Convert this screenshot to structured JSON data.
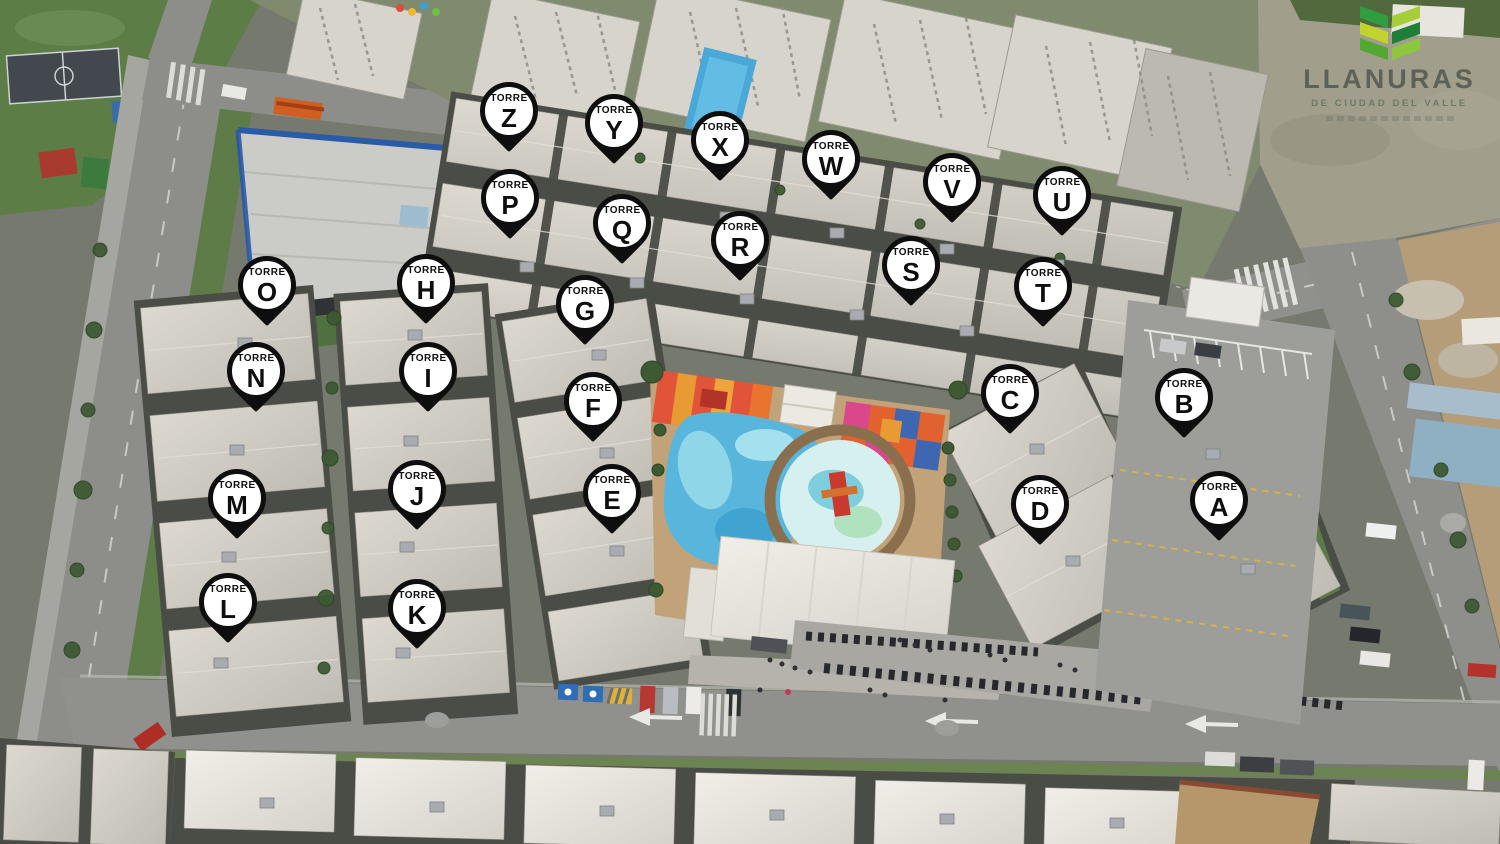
{
  "brand": {
    "name": "LLANURAS",
    "tagline": "DE CIUDAD DEL VALLE",
    "icon": "llanuras-leaves-icon",
    "name_color": "#585d55",
    "tagline_color": "#5f7761",
    "leaf_colors": [
      "#2f9e41",
      "#a6ce39",
      "#c3d32e",
      "#1f7e37",
      "#53a834",
      "#8dc63f"
    ]
  },
  "map": {
    "marker_word": "TORRE",
    "marker_colors": {
      "fill": "#ffffff",
      "border": "#0e0e0e",
      "text": "#0e0e0e"
    },
    "towers": [
      {
        "letter": "A",
        "x": 1219,
        "y": 500
      },
      {
        "letter": "B",
        "x": 1184,
        "y": 397
      },
      {
        "letter": "C",
        "x": 1010,
        "y": 393
      },
      {
        "letter": "D",
        "x": 1040,
        "y": 504
      },
      {
        "letter": "E",
        "x": 612,
        "y": 493
      },
      {
        "letter": "F",
        "x": 593,
        "y": 401
      },
      {
        "letter": "G",
        "x": 585,
        "y": 304
      },
      {
        "letter": "H",
        "x": 426,
        "y": 283
      },
      {
        "letter": "I",
        "x": 428,
        "y": 371
      },
      {
        "letter": "J",
        "x": 417,
        "y": 489
      },
      {
        "letter": "K",
        "x": 417,
        "y": 608
      },
      {
        "letter": "L",
        "x": 228,
        "y": 602
      },
      {
        "letter": "M",
        "x": 237,
        "y": 498
      },
      {
        "letter": "N",
        "x": 256,
        "y": 371
      },
      {
        "letter": "O",
        "x": 267,
        "y": 285
      },
      {
        "letter": "P",
        "x": 510,
        "y": 198
      },
      {
        "letter": "Q",
        "x": 622,
        "y": 223
      },
      {
        "letter": "R",
        "x": 740,
        "y": 240
      },
      {
        "letter": "S",
        "x": 911,
        "y": 265
      },
      {
        "letter": "T",
        "x": 1043,
        "y": 286
      },
      {
        "letter": "U",
        "x": 1062,
        "y": 195
      },
      {
        "letter": "V",
        "x": 952,
        "y": 182
      },
      {
        "letter": "W",
        "x": 831,
        "y": 159
      },
      {
        "letter": "X",
        "x": 720,
        "y": 140
      },
      {
        "letter": "Y",
        "x": 614,
        "y": 123
      },
      {
        "letter": "Z",
        "x": 509,
        "y": 111
      }
    ]
  },
  "scene": {
    "description": "aerial photo of residential complex with lettered tower markers",
    "features": [
      "apartment-roofs",
      "swimming-pool",
      "splash-pad",
      "playgrounds",
      "clubhouse",
      "roads",
      "parking-lots",
      "motorcycle-parking",
      "sports-court",
      "green-areas",
      "warehouse"
    ],
    "colors": {
      "pool": "#58b6dc",
      "deck": "#c2a379",
      "roof": "#d2cfc7",
      "asphalt": "#8f908c",
      "grass": "#5e7c48",
      "shadow": "#4a4d45"
    }
  }
}
